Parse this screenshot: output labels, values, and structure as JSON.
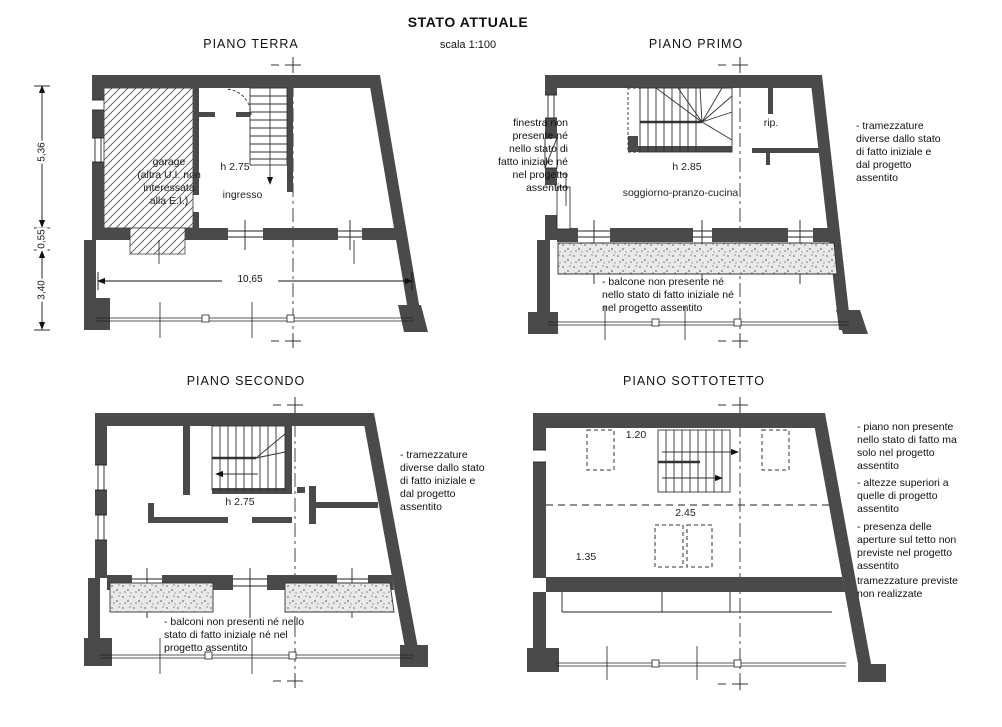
{
  "header": {
    "title": "STATO ATTUALE",
    "scale": "scala 1:100"
  },
  "plans": {
    "terra": {
      "title": "PIANO TERRA",
      "garage_label": "garage\n(altra U.I. non\ninteressata\nalla E.I.)",
      "height_label": "h 2.75",
      "room_label": "ingresso",
      "dim_width": "10,65",
      "dim_left_top": "5,36",
      "dim_left_mid": "0,55",
      "dim_left_bottom": "3,40"
    },
    "primo": {
      "title": "PIANO PRIMO",
      "storage_label": "rip.",
      "height_label": "h 2.85",
      "room_label": "soggiorno-pranzo-cucina",
      "note_window": "finestra non\npresente né\nnello stato di\nfatto iniziale né\nnel progetto\nassentito",
      "note_partitions": "- tramezzature\ndiverse dallo stato\ndi fatto iniziale e\ndal progetto\nassentito",
      "note_balcony": "- balcone non presente né\nnello stato di fatto iniziale né\nnel progetto assentito"
    },
    "secondo": {
      "title": "PIANO SECONDO",
      "height_label": "h 2.75",
      "note_partitions": "- tramezzature\ndiverse dallo stato\ndi fatto iniziale e\ndal progetto\nassentito",
      "note_balconies": "- balconi non presenti né nello\nstato di fatto iniziale né nel\nprogetto assentito"
    },
    "sottotetto": {
      "title": "PIANO SOTTOTETTO",
      "dim_height_1": "1.20",
      "dim_height_2": "2.45",
      "dim_height_3": "1.35",
      "note_floor": "- piano non presente\nnello stato di fatto ma\nsolo nel progetto\nassentito",
      "note_heights": "- altezze superiori a\nquelle di progetto\nassentito",
      "note_openings": "- presenza delle\naperture sul tetto non\npreviste nel progetto\nassentito",
      "note_partitions": "tramezzature previste\nnon realizzate"
    }
  },
  "colors": {
    "wall": "#4a4a4a",
    "line": "#1a1a1a",
    "hatch": "#5a5a5a",
    "stipple_bg": "#e9e9e9"
  }
}
